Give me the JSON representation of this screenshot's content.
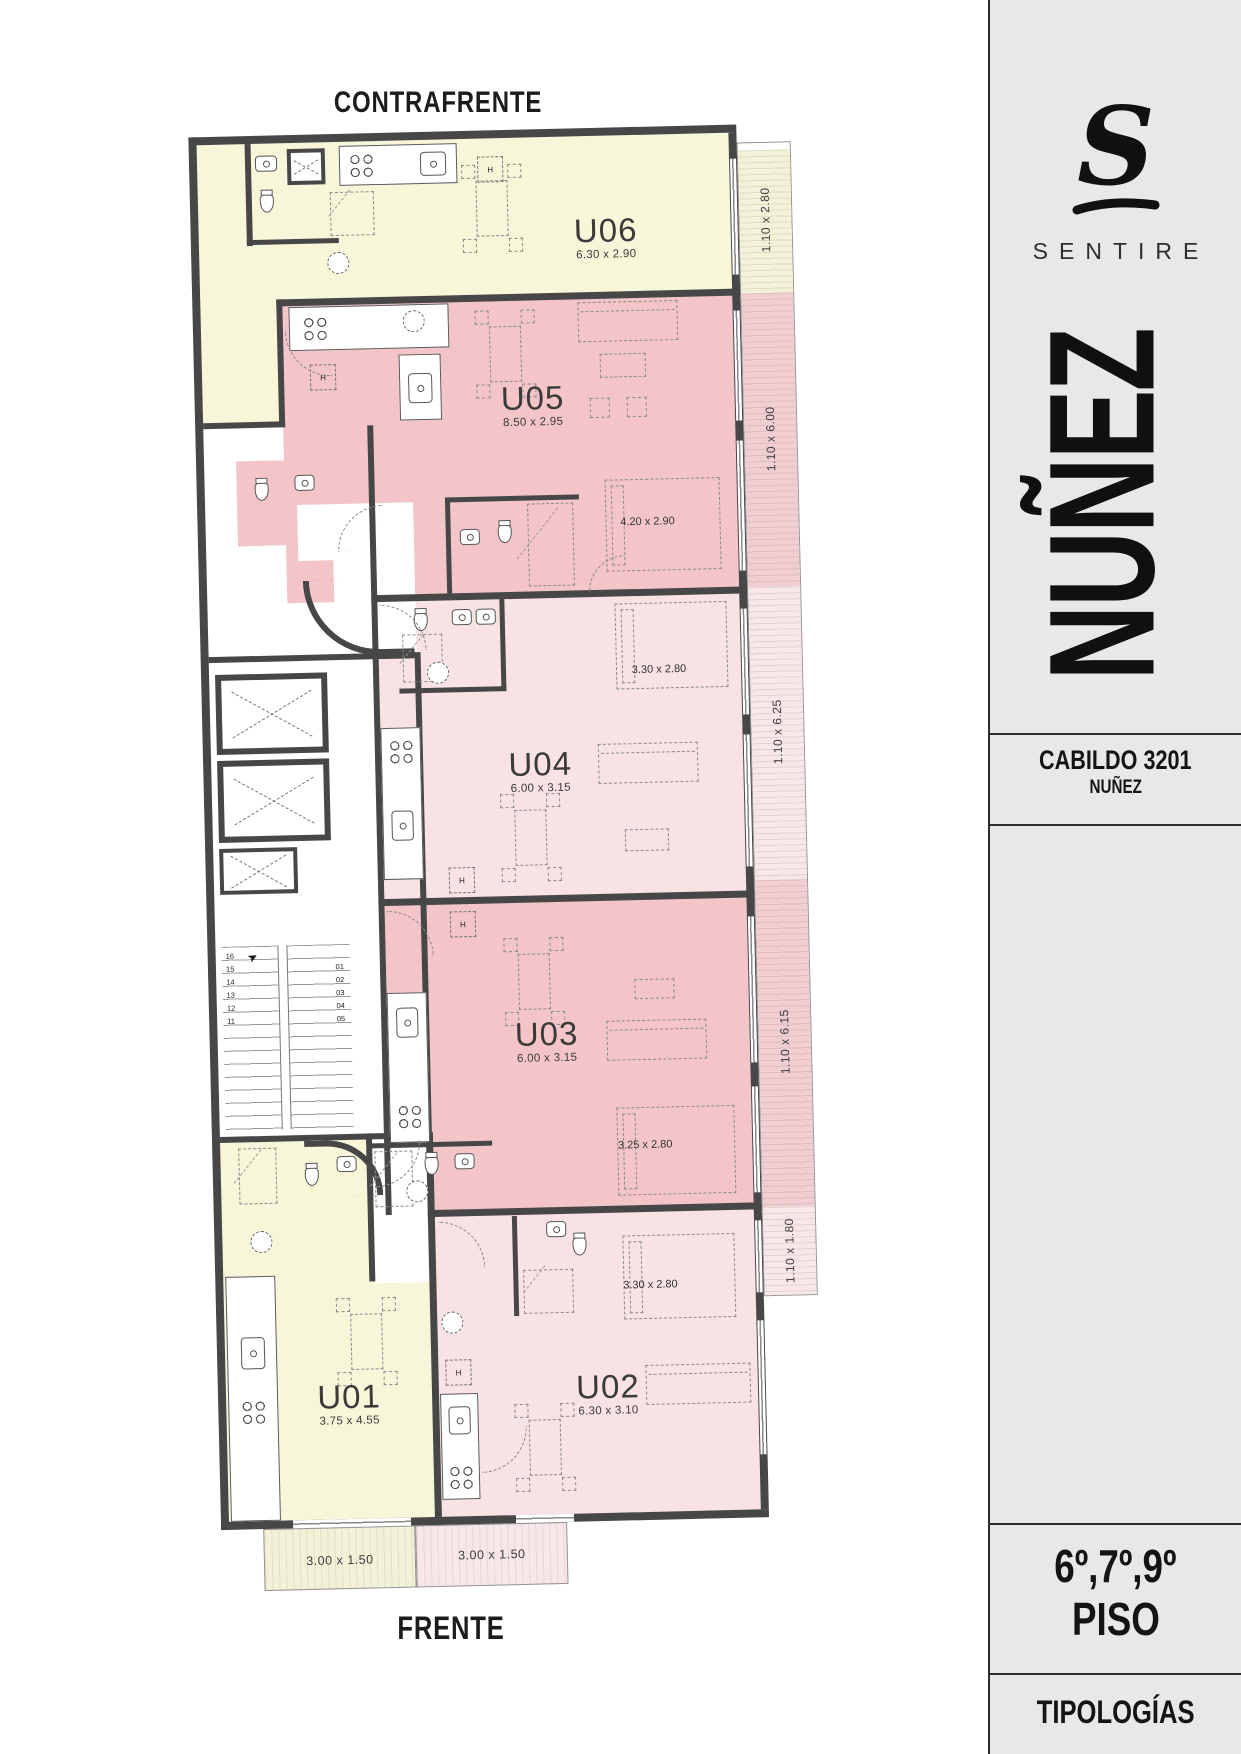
{
  "palette": {
    "wall": "#474747",
    "ink": "#1b1b1b",
    "line": "#2e2e2e",
    "paper": "#ffffff",
    "yellow": "#f8f6d9",
    "pink": "#f4c5c8",
    "pinklight": "#f8e2e3",
    "balyellow": "#f3f2d8",
    "balpink": "#f1ced1",
    "balpinklight": "#f8e7e8",
    "sidebarbg": "#e8e8e6",
    "dash": "#8a8a8a"
  },
  "titles": {
    "back": "CONTRAFRENTE",
    "front": "FRENTE"
  },
  "units": [
    {
      "id": "U01",
      "dims": "3.75 x 4.55"
    },
    {
      "id": "U02",
      "dims": "6.30 x 3.10"
    },
    {
      "id": "U03",
      "dims": "6.00 x 3.15"
    },
    {
      "id": "U04",
      "dims": "6.00 x 3.15"
    },
    {
      "id": "U05",
      "dims": "8.50 x 2.95"
    },
    {
      "id": "U06",
      "dims": "6.30 x 2.90"
    }
  ],
  "rooms": {
    "u05_bedroom": "4.20 x 2.90",
    "u04_bedroom": "3.30 x 2.80",
    "u03_bedroom": "3.25 x 2.80",
    "u02_bedroom": "3.30 x 2.80"
  },
  "balconies": {
    "side": [
      "1.10 x 2.80",
      "1.10 x 6.00",
      "1.10 x 6.25",
      "1.10 x 6.15",
      "1.10 x 1.80"
    ],
    "front": [
      "3.00 x 1.50",
      "3.00 x 1.50"
    ]
  },
  "markers": {
    "closet": "H"
  },
  "stairs": {
    "left": [
      "16",
      "15",
      "14",
      "13",
      "12",
      "11"
    ],
    "right": [
      "01",
      "02",
      "03",
      "04",
      "05"
    ]
  },
  "sidebar": {
    "logo_letter": "S",
    "brand": "SENTIRE",
    "project": "NUÑEZ",
    "address_line1": "CABILDO 3201",
    "address_line2": "NUÑEZ",
    "floors": "6º,7º,9º",
    "floor_word": "PISO",
    "footer": "TIPOLOGÍAS"
  }
}
